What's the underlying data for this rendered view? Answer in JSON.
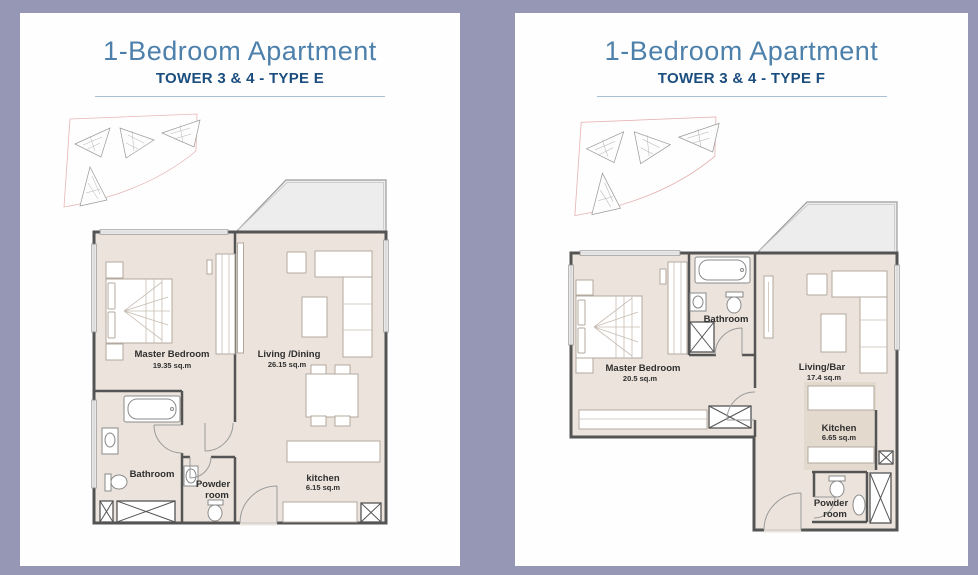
{
  "colors": {
    "page_background": "#9597b4",
    "panel_background": "#fefefe",
    "title_blue": "#4d80ab",
    "subtitle_navy": "#1b4d7e",
    "rule_blue": "#a9c0d4",
    "floor_beige": "#ece4dc",
    "wall_gray": "#545454",
    "balcony_gray": "#ededed",
    "site_outline_pink": "#e7b6b6"
  },
  "panels": [
    {
      "title": "1-Bedroom Apartment",
      "subtitle": "TOWER 3 & 4 - TYPE E",
      "labels": {
        "master_name": "Master Bedroom",
        "master_area": "19.35 sq.m",
        "living_name": "Living /Dining",
        "living_area": "26.15 sq.m",
        "bathroom": "Bathroom",
        "powder_line1": "Powder",
        "powder_line2": "room",
        "kitchen_name": "kitchen",
        "kitchen_area": "6.15 sq.m"
      }
    },
    {
      "title": "1-Bedroom Apartment",
      "subtitle": "TOWER 3 & 4 - TYPE F",
      "labels": {
        "master_name": "Master Bedroom",
        "master_area": "20.5 sq.m",
        "bathroom": "Bathroom",
        "living_name": "Living/Bar",
        "living_area": "17.4 sq.m",
        "kitchen_name": "Kitchen",
        "kitchen_area": "6.65 sq.m",
        "powder_line1": "Powder",
        "powder_line2": "room"
      }
    }
  ]
}
